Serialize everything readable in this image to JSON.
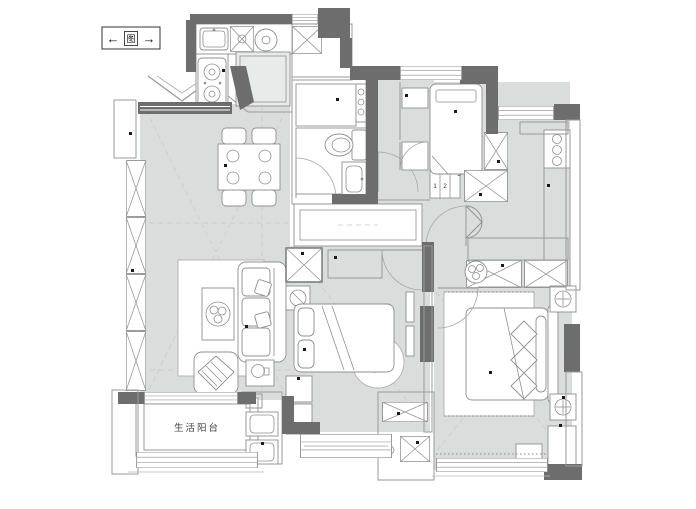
{
  "title": "apartment-floor-plan",
  "compass": {
    "left_arrow": "←",
    "symbol": "图",
    "right_arrow": "→"
  },
  "rooms": {
    "service_balcony": {
      "label": "生活阳台"
    }
  },
  "annotations": {
    "step_numbers": [
      "1",
      "2",
      "3"
    ]
  },
  "colors": {
    "wall": "#6d6d6d",
    "floor": "#dbdcdc",
    "furniture_line": "#8f8f8f",
    "hatch": "#adadad",
    "guide": "#c8c8c8",
    "paper": "#ffffff"
  }
}
